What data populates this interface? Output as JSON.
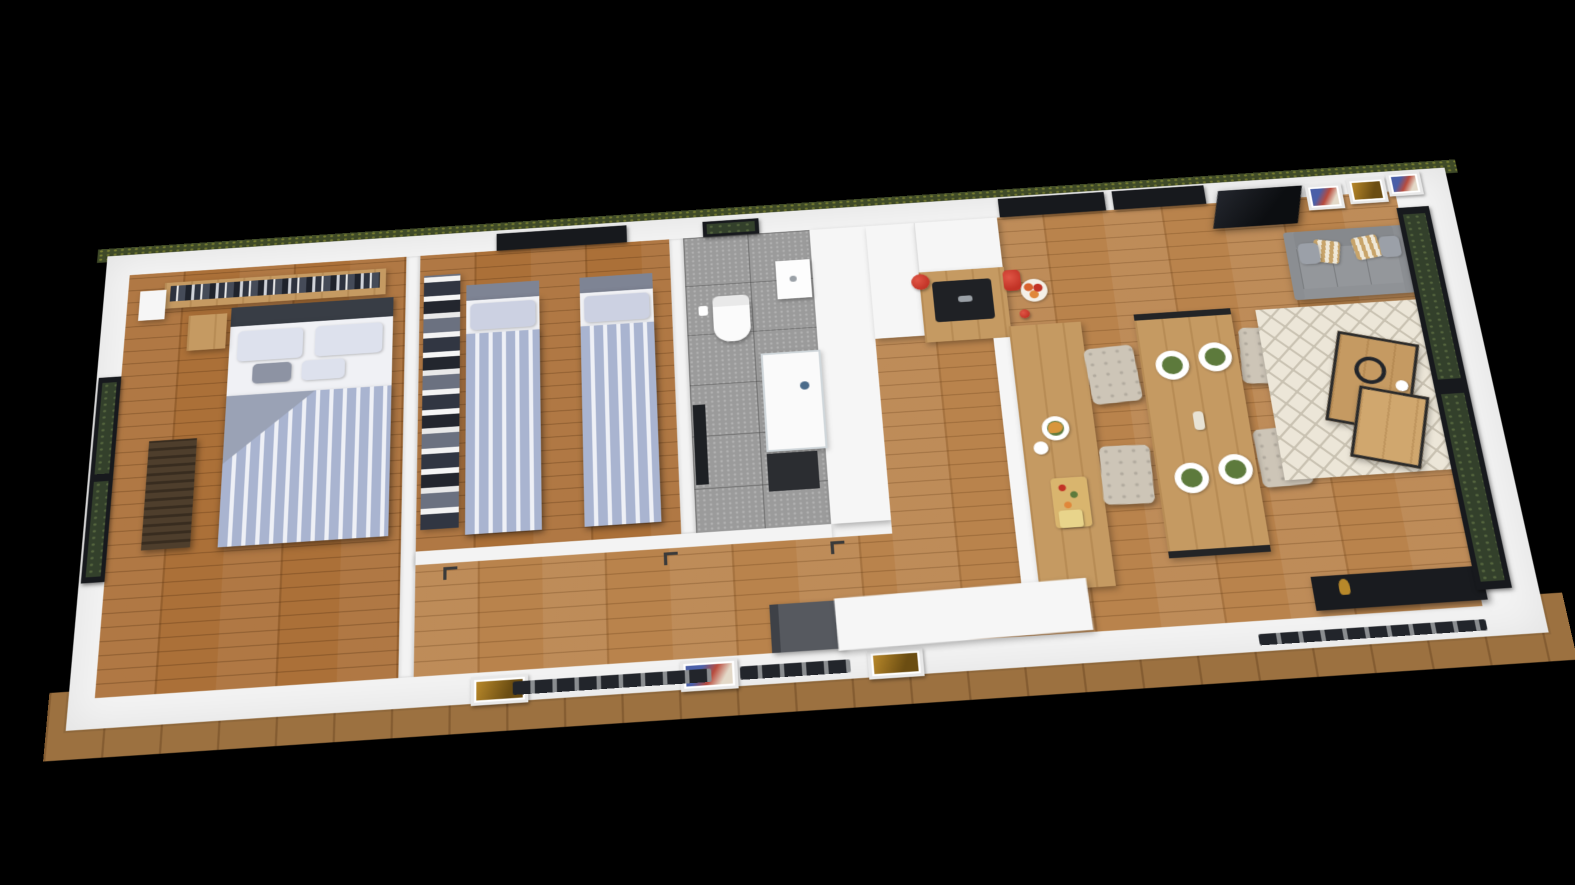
{
  "scene": {
    "type": "3d-floorplan-aerial-render",
    "description": "Photoreal cutaway 3D render of an elongated single-storey tiny house, viewed from above at an angle on a black background",
    "background": "#000000",
    "orientation": "long axis runs left-to-right, tilted slightly clockwise, near edge enlarged by perspective"
  },
  "palette": {
    "wall": "#f3f3f3",
    "woodFloor": "#b9834c",
    "woodFloorDark": "#ab7038",
    "woodDeck": "#9c7140",
    "counterWood": "#c59a62",
    "tile": "#9b9b9b",
    "sofa": "#8f9296",
    "duvet": "#a9b4d0",
    "duvetStripe": "#eef0f6",
    "chair": "#cdc5b7",
    "windowFrame": "#17191d",
    "greenery": "#33402b",
    "grass": "#3f4a28",
    "accentRed": "#c23326",
    "plateGreen": "#5d7a3c",
    "frameGold": "#b8882a",
    "consoleBlack": "#191b1f",
    "headboardDark": "#383d45",
    "headboardGray": "#7e8494",
    "matDark": "#2b2d31",
    "benchGray": "#56595f",
    "rugBase": "#ece6d8",
    "rugLine": "#c9c2b2"
  },
  "rooms": {
    "master_bedroom": {
      "floor": "wood",
      "furniture": [
        "double-bed with striped duvet",
        "dark headboard",
        "wall shelf with books",
        "nightstand",
        "wicker storage chest",
        "full-height picture window with greenery"
      ]
    },
    "kids_bedroom": {
      "floor": "wood",
      "furniture": [
        "single bed left",
        "single bed right",
        "bookshelf column",
        "dark window on top wall"
      ],
      "beds": 2
    },
    "bathroom": {
      "floor": "gray tile",
      "furniture": [
        "toilet",
        "wall wash-basin",
        "glass shower with tray",
        "dark bath mat",
        "wall mirror",
        "small window with greenery"
      ]
    },
    "hallway": {
      "floor": "wood",
      "picture_frames": 3,
      "door_handles": 3
    },
    "kitchen": {
      "floor": "wood",
      "furniture": [
        "tall white cabinet",
        "white upper cabinets",
        "L-shaped oak counter",
        "peninsula bar"
      ],
      "props": [
        "black sink with faucet",
        "red kettle",
        "red stand mixer",
        "fruit bowl",
        "croissant plate",
        "coffee cup",
        "cutting board with food",
        "cheese block"
      ],
      "windows": 2
    },
    "dining_area": {
      "floor": "wood",
      "furniture": [
        "oak dining table with black metal legs",
        "tufted beige chairs"
      ],
      "chairs": 4,
      "place_settings": 4
    },
    "living_room": {
      "floor": "wood",
      "furniture": [
        "gray three-seat sofa",
        "diamond-pattern cream rug",
        "nesting oak coffee tables",
        "black tv console",
        "wall tv panel",
        "floor-to-ceiling glass wall with greenery"
      ],
      "sofa_pillows": 4,
      "picture_frames": 3,
      "props": [
        "headphones",
        "coffee cup",
        "gold cat figurine"
      ]
    },
    "entry": {
      "furniture": [
        "white storage cabinet",
        "dark gray bench"
      ]
    }
  },
  "exterior": {
    "deck": "wood strip along near edge",
    "grass_edge": "thin green strip beyond far wall",
    "bottom_wall_windows": 3
  }
}
